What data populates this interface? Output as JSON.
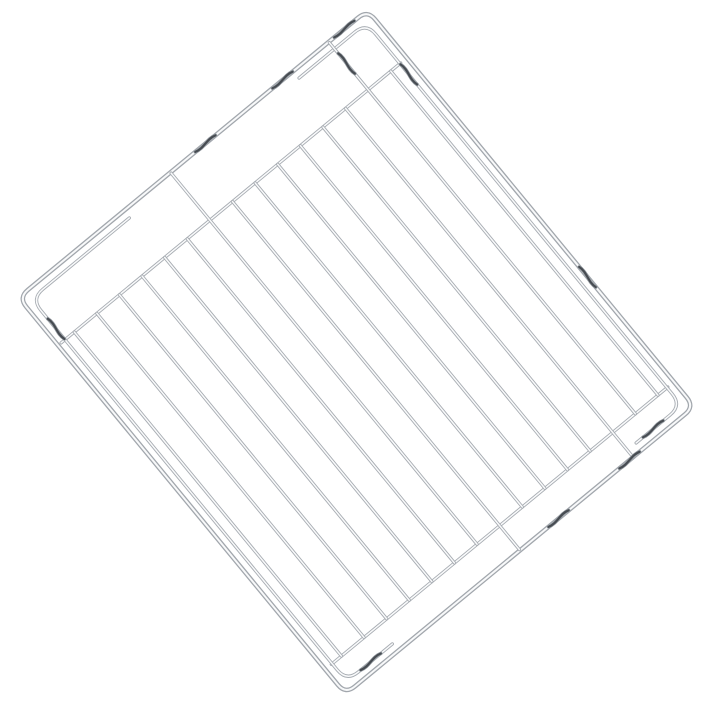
{
  "scene": {
    "type": "product-photo",
    "subject": "Chrome wire oven grill rack shown diagonally on a white background",
    "background_color": "#ffffff"
  },
  "canvas": {
    "width": 706,
    "height": 720
  },
  "rack": {
    "origin": {
      "x": 13,
      "y": 297
    },
    "rotation_deg": -39.5,
    "width": 460,
    "height": 522,
    "frame": {
      "inset": 4,
      "corner_radius": 12,
      "base_color": "#a2a7ad",
      "base_width": 4.6,
      "core_color": "#f8f9fa",
      "core_width": 2.0
    },
    "wire_style": {
      "base_color": "#a7acb2",
      "base_width": 3.3,
      "core_color": "#f9fafb",
      "core_width": 1.5
    },
    "grid_wires": {
      "count": 15,
      "first_x": 25,
      "spacing": 29.3,
      "rail_top_y": 66,
      "rail_bottom_y": 486,
      "frame_top_y": 5,
      "frame_bottom_y": 517,
      "back_connector_indices": [
        6,
        13
      ],
      "front_connector_indices": [
        7,
        12
      ]
    },
    "back_rail": {
      "y": 66,
      "x1": 8,
      "x2": 448
    },
    "front_rail": {
      "y": 486,
      "x1": 12,
      "x2": 448
    },
    "runners": {
      "left": {
        "top_stub_x": 140,
        "side_x": 13,
        "top_y": 13,
        "corner_r": 15,
        "side_end_y": 494,
        "front_y": 509,
        "front_stub_x": 72
      },
      "right": {
        "top_stub_x": 360,
        "side_x": 447,
        "top_y": 13,
        "corner_r": 15,
        "side_end_y": 494,
        "front_y": 509,
        "front_stub_x": 388
      }
    },
    "kinks": {
      "under_color": "#9aa0a6",
      "under_width": 3.6,
      "color": "#474c52",
      "width": 2.2,
      "half_length": 13,
      "amplitude": 3,
      "items": [
        {
          "name": "back-edge-stop-bend-1",
          "x": 246,
          "y": 4,
          "dir": "h"
        },
        {
          "name": "back-edge-stop-bend-2",
          "x": 346,
          "y": 4,
          "dir": "h"
        },
        {
          "name": "back-edge-stop-bend-3",
          "x": 426,
          "y": 4,
          "dir": "h"
        },
        {
          "name": "front-edge-stop-bend-1",
          "x": 280,
          "y": 518,
          "dir": "h"
        },
        {
          "name": "front-edge-stop-bend-2",
          "x": 372,
          "y": 518,
          "dir": "h"
        },
        {
          "name": "right-frame-edge-stop-bend",
          "x": 456,
          "y": 350,
          "dir": "v"
        },
        {
          "name": "left-runner-top-bend",
          "x": 13,
          "y": 52,
          "dir": "v"
        },
        {
          "name": "right-runner-top-bend",
          "x": 447,
          "y": 80,
          "dir": "v"
        },
        {
          "name": "left-runner-front-bend",
          "x": 44,
          "y": 509,
          "dir": "h"
        },
        {
          "name": "right-runner-front-bend",
          "x": 410,
          "y": 509,
          "dir": "h"
        },
        {
          "name": "back-connector-wire-bend",
          "x": 405.9,
          "y": 32,
          "dir": "v"
        }
      ]
    }
  }
}
